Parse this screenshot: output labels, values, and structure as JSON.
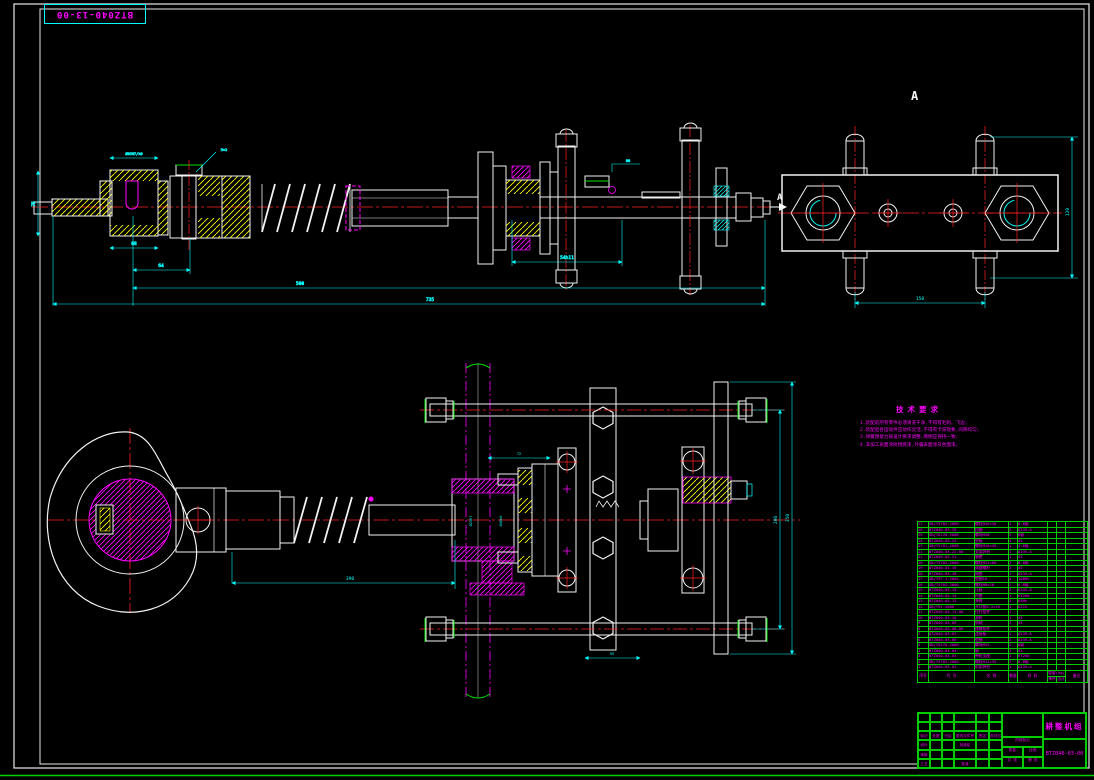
{
  "frame": {
    "tag": "BTZ040-13-00"
  },
  "labels": {
    "section_view": "A",
    "section_arrow": "A"
  },
  "colors": {
    "background": "#000000",
    "outline": "#f2f2f2",
    "dimension": "#00ffff",
    "centerline": "#ff2020",
    "detail": "#ff00ff",
    "hatch": "#ffff00",
    "table_grid": "#00cc00"
  },
  "tech_requirements": {
    "title": "技术要求",
    "lines": [
      "1.装配前所有零件必须清洗干净,不得有毛刺、飞边;",
      "2.装配后各运动件应动作灵活,不得有卡滞现象,间隙均匀;",
      "3.弹簧预紧力按设计要求调整,两侧应保持一致;",
      "4.非加工表面涂防锈底漆,外露表面涂灰色面漆。"
    ]
  },
  "dims": {
    "top": {
      "d1": "Ø35H7/k6",
      "d2": "5×2",
      "d3": "75",
      "d4": "68",
      "d5": "64",
      "d6": "54h11",
      "d7": "500",
      "d8": "735",
      "d9": "M8"
    },
    "view_a": {
      "width": "150",
      "height": "120"
    },
    "bottom": {
      "b1": "390",
      "b2": "Ø25H7",
      "b3": "Ø40k6",
      "b4": "72",
      "b5": "95",
      "b6": "206",
      "b7": "350"
    }
  },
  "bom": {
    "headers": {
      "no": "序号",
      "code": "代  号",
      "name": "名  称",
      "qty": "数量",
      "material": "材  料",
      "weight": "重量(kg)",
      "unit": "单件",
      "total": "总计",
      "note": "备注"
    },
    "rows": [
      {
        "no": "27",
        "code": "GB/T5783-2000",
        "name": "螺栓M10×30",
        "qty": "2",
        "material": "8.8级",
        "unit": "",
        "total": "",
        "note": ""
      },
      {
        "no": "26",
        "code": "BTZ040-03-26",
        "name": "挡圈",
        "qty": "2",
        "material": "Q235-A",
        "unit": "",
        "total": "",
        "note": ""
      },
      {
        "no": "25",
        "code": "GB/T6170-2000",
        "name": "螺母M10",
        "qty": "2",
        "material": "8级",
        "unit": "",
        "total": "",
        "note": ""
      },
      {
        "no": "24",
        "code": "BTZ040-03-24",
        "name": "垫板",
        "qty": "4",
        "material": "45",
        "unit": "",
        "total": "",
        "note": ""
      },
      {
        "no": "23",
        "code": "GB/T5781-2000",
        "name": "螺栓M10×45",
        "qty": "1",
        "material": "4.8级",
        "unit": "",
        "total": "",
        "note": ""
      },
      {
        "no": "22",
        "code": "BTZ040-03-22-00",
        "name": "支架焊合",
        "qty": "1",
        "material": "Q235-A",
        "unit": "",
        "total": "",
        "note": ""
      },
      {
        "no": "21",
        "code": "BTZ040-03-21",
        "name": "轴套",
        "qty": "1",
        "material": "45",
        "unit": "",
        "total": "",
        "note": ""
      },
      {
        "no": "20",
        "code": "GB/T5782-2000",
        "name": "螺栓M12×80",
        "qty": "2",
        "material": "8.8级",
        "unit": "",
        "total": "",
        "note": ""
      },
      {
        "no": "19",
        "code": "BTZ040-03-19",
        "name": "调整螺杆",
        "qty": "2",
        "material": "45",
        "unit": "",
        "total": "",
        "note": ""
      },
      {
        "no": "18",
        "code": "BTZ040-03-18",
        "name": "隔套",
        "qty": "1",
        "material": "Q235-A",
        "unit": "",
        "total": "",
        "note": ""
      },
      {
        "no": "17",
        "code": "GB/T97.1-2002",
        "name": "垫圈10",
        "qty": "4",
        "material": "100HV",
        "unit": "",
        "total": "",
        "note": ""
      },
      {
        "no": "16",
        "code": "GB/T5783-2000",
        "name": "螺栓M8×20",
        "qty": "2",
        "material": "8.8级",
        "unit": "",
        "total": "",
        "note": ""
      },
      {
        "no": "15",
        "code": "BTZ040-03-15",
        "name": "压板",
        "qty": "2",
        "material": "Q235-A",
        "unit": "",
        "total": "",
        "note": ""
      },
      {
        "no": "14",
        "code": "BTZ040-03-14",
        "name": "衬套",
        "qty": "1",
        "material": "HT200",
        "unit": "",
        "total": "",
        "note": ""
      },
      {
        "no": "13",
        "code": "BTZ040-03-13",
        "name": "弹簧",
        "qty": "2",
        "material": "65Mn",
        "unit": "",
        "total": "",
        "note": ""
      },
      {
        "no": "12",
        "code": "GB/T91-2000",
        "name": "开口销3.2×25",
        "qty": "4",
        "material": "Q215",
        "unit": "",
        "total": "",
        "note": ""
      },
      {
        "no": "11",
        "code": "BTZ040-03-11-00",
        "name": "拉杆组件",
        "qty": "1",
        "material": "",
        "unit": "",
        "total": "",
        "note": ""
      },
      {
        "no": "10",
        "code": "BTZ040-03-10",
        "name": "滚轮",
        "qty": "1",
        "material": "45",
        "unit": "",
        "total": "",
        "note": ""
      },
      {
        "no": "9",
        "code": "BTZ040-03-09",
        "name": "销轴",
        "qty": "2",
        "material": "45",
        "unit": "",
        "total": "",
        "note": ""
      },
      {
        "no": "8",
        "code": "BTZ040-03-08-00",
        "name": "摆臂组件",
        "qty": "1",
        "material": "",
        "unit": "",
        "total": "",
        "note": ""
      },
      {
        "no": "7",
        "code": "BTZ040-03-07",
        "name": "连接板",
        "qty": "2",
        "material": "Q235-A",
        "unit": "",
        "total": "",
        "note": ""
      },
      {
        "no": "6",
        "code": "BTZ040-03-06",
        "name": "垫圈",
        "qty": "2",
        "material": "Q235-A",
        "unit": "",
        "total": "",
        "note": ""
      },
      {
        "no": "5",
        "code": "GB/T6170-2000",
        "name": "螺母M12",
        "qty": "2",
        "material": "8级",
        "unit": "",
        "total": "",
        "note": ""
      },
      {
        "no": "4",
        "code": "BTZ040-03-04",
        "name": "轴",
        "qty": "1",
        "material": "45",
        "unit": "",
        "total": "",
        "note": ""
      },
      {
        "no": "3",
        "code": "BTZ040-03-03",
        "name": "带轮支座",
        "qty": "1",
        "material": "HT200",
        "unit": "",
        "total": "",
        "note": ""
      },
      {
        "no": "2",
        "code": "GB/T5783-2000",
        "name": "螺栓M12×35",
        "qty": "2",
        "material": "8.8级",
        "unit": "",
        "total": "",
        "note": ""
      },
      {
        "no": "1",
        "code": "BTZ040-03-01",
        "name": "机架焊合",
        "qty": "1",
        "material": "Q235-A",
        "unit": "",
        "total": "",
        "note": ""
      }
    ]
  },
  "title_block": {
    "left_rows": [
      [
        "",
        "",
        "",
        "",
        "",
        ""
      ],
      [
        "",
        "",
        "",
        "",
        "",
        ""
      ],
      [
        "标记",
        "处数",
        "分区",
        "更改文件号",
        "签名",
        "年月日"
      ],
      [
        "设计",
        "",
        "",
        "标准化",
        "",
        ""
      ],
      [
        "审核",
        "",
        "",
        "",
        "",
        ""
      ],
      [
        "工艺",
        "",
        "",
        "批准",
        "",
        ""
      ]
    ],
    "stage_label": "阶段标记",
    "mass_label": "质量",
    "scale_label": "比例",
    "sheets_label": "共 张",
    "sheet_label": "第 张",
    "name": "耕整机组",
    "number": "BTZ040-03-00"
  }
}
